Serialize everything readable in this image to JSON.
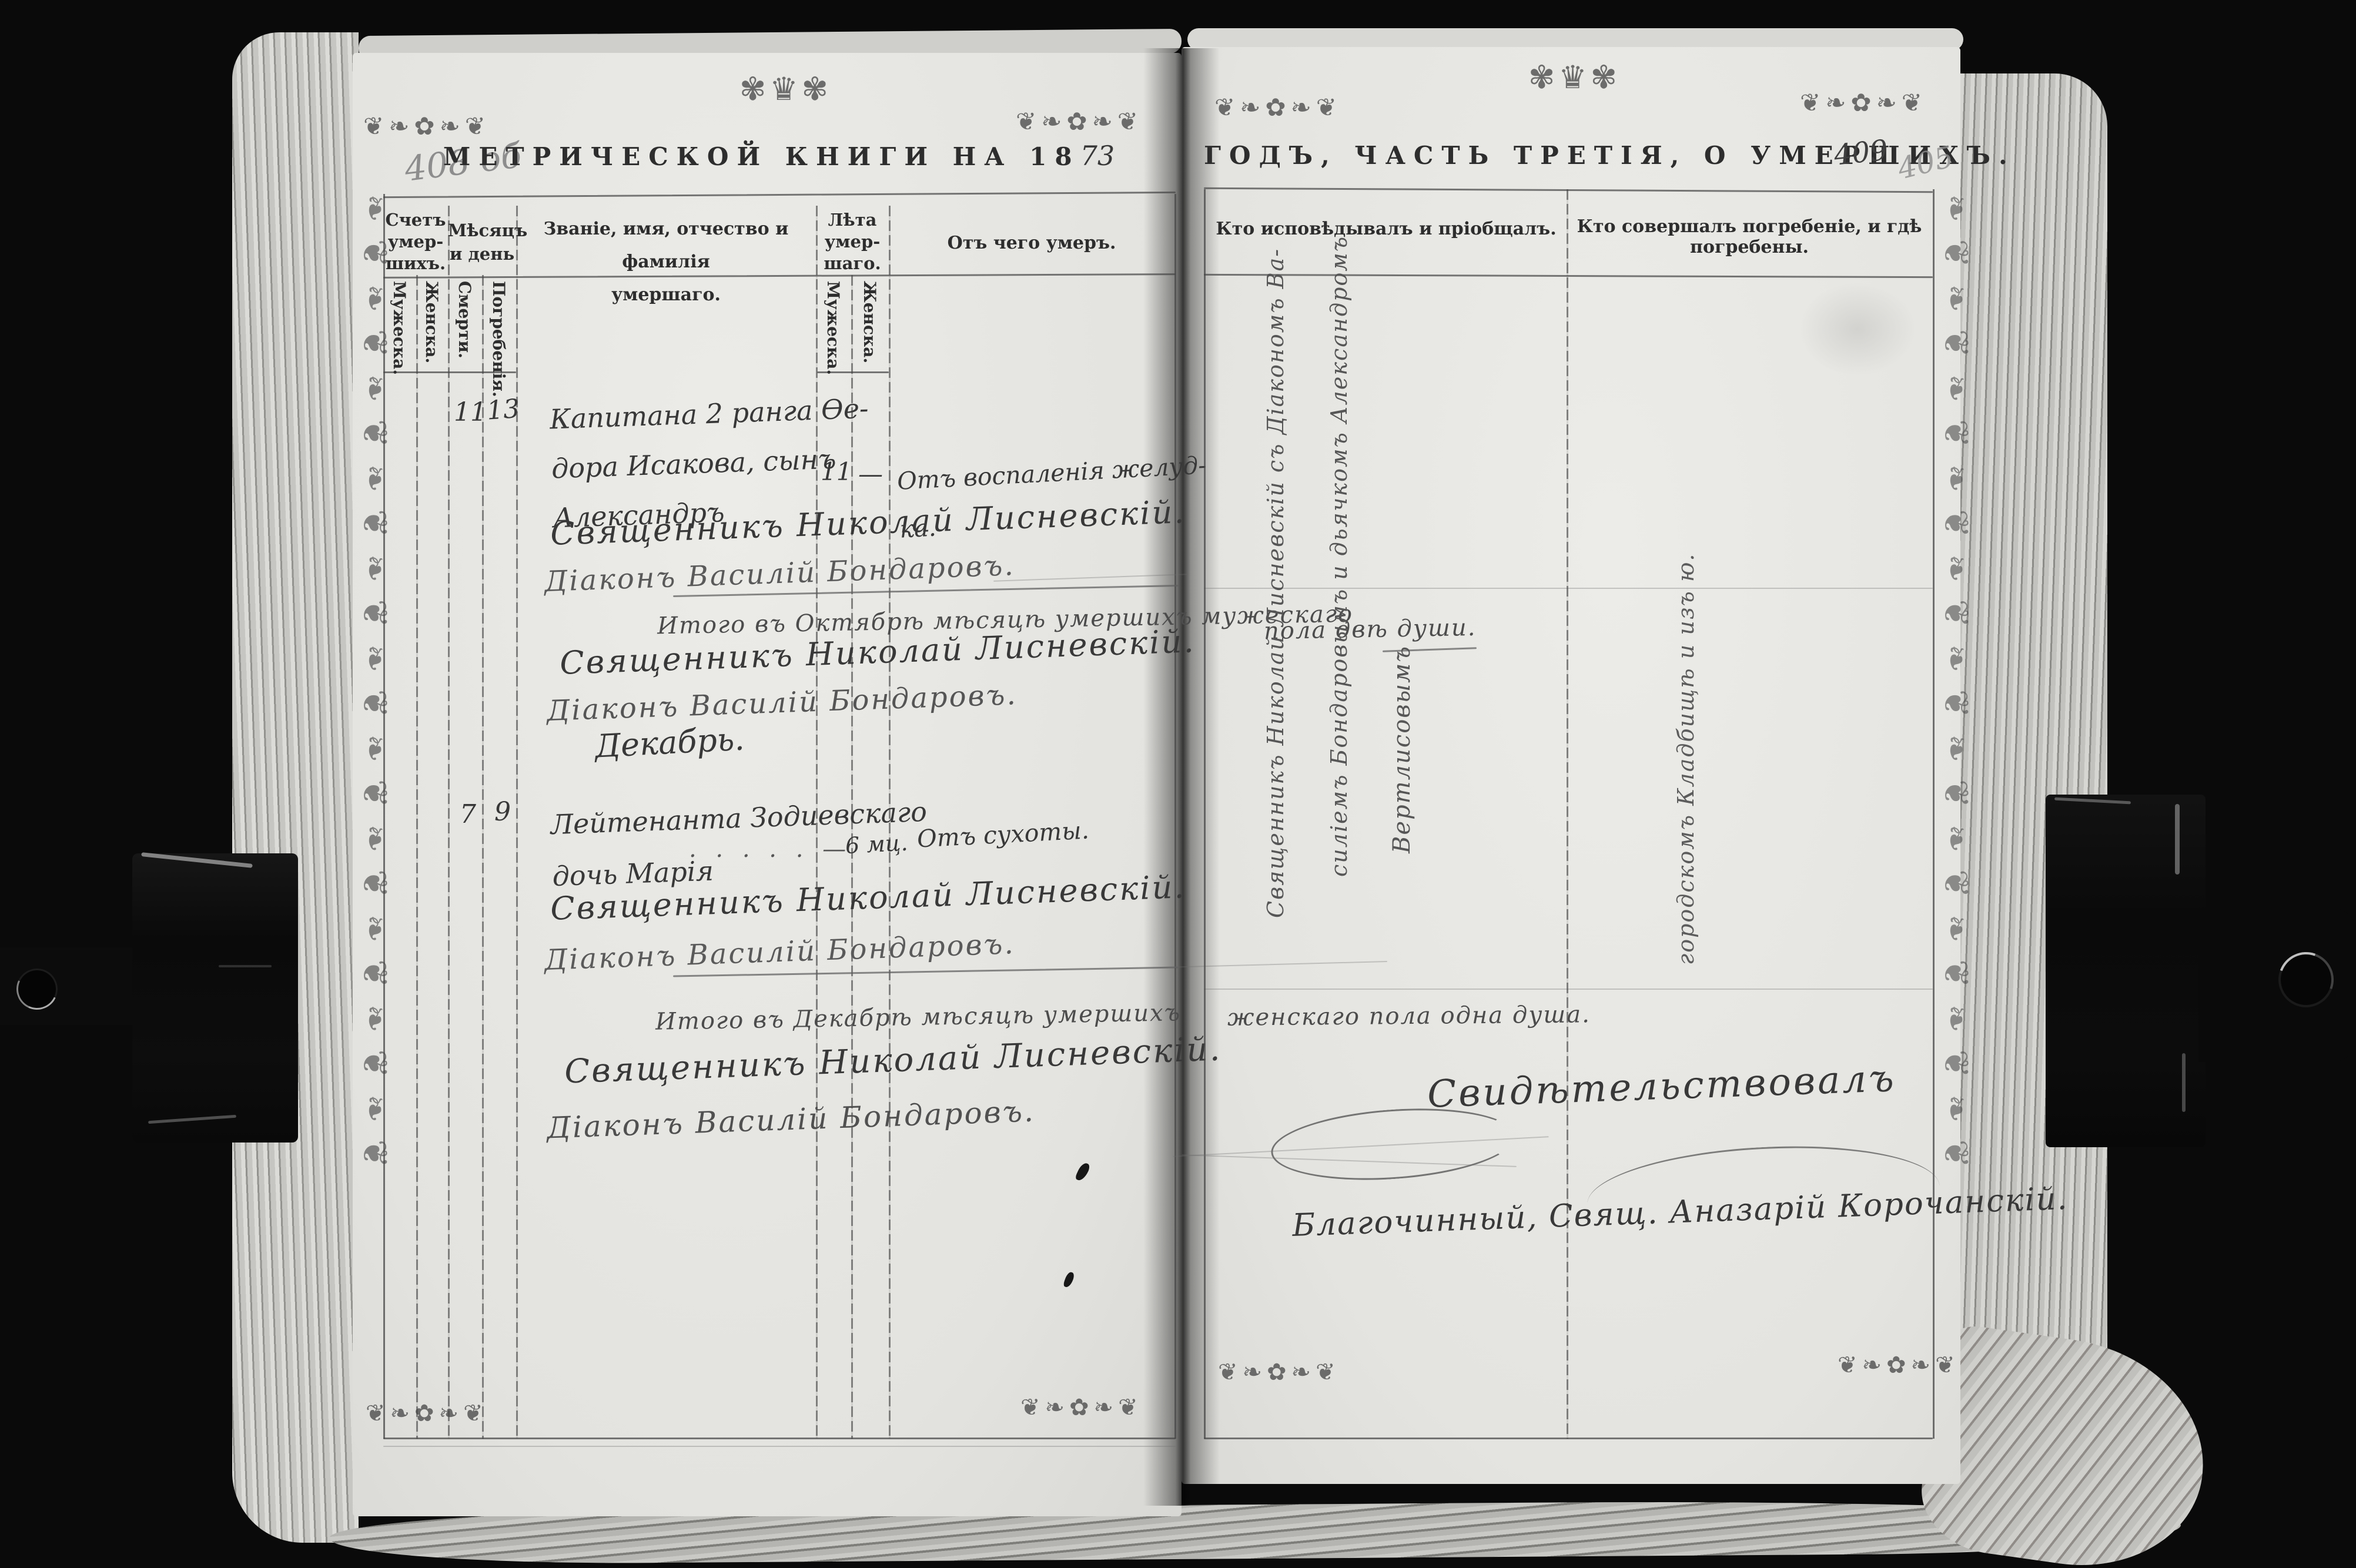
{
  "decor": {
    "corner": "❦❧✿❧❦",
    "crown": "✾♛✾",
    "strip": "❧❦❧❦❧❦❧❦❧❦❧❦❧❦❧❦❧❦❧❦❧❦"
  },
  "left_page": {
    "page_number_pencil": "408 об",
    "title_printed": "МЕТРИЧЕСКОЙ КНИГИ НА 18",
    "title_year_handwritten": "73",
    "columns": {
      "count_title": "Счетъ\nумер-\nшихъ.",
      "count_male": "Мужеска.",
      "count_female": "Женска.",
      "month_title": "Мѣсяцъ\nи день",
      "month_death": "Смерти.",
      "month_burial": "Погребенія.",
      "name_title": "Званіе, имя, отчество и фамилія\nумершаго.",
      "age_title": "Лѣта\nумер-\nшаго.",
      "age_male": "Мужеска.",
      "age_female": "Женска.",
      "cause_title": "Отъ чего умеръ."
    },
    "entries": [
      {
        "death_day": "11",
        "burial_day": "13",
        "name_lines": "Капитана 2 ранга Ѳе-\nдора Исакова, сынъ\nАлександръ",
        "age_male": "11",
        "age_female": "—",
        "cause_lines": "Отъ воспаленія желуд-\nка.",
        "priest": "Священникъ Николай Лисневскій.",
        "deacon": "Діаконъ Василій Бондаровъ."
      },
      {
        "death_day": "7",
        "burial_day": "9",
        "name_lines": "Лейтенанта Зодиевскаго\nдочь Марія",
        "leader": ". . . . . —",
        "age_female": "6 мц.",
        "cause_lines": "Отъ сухоты.",
        "priest": "Священникъ Николай Лисневскій.",
        "deacon": "Діаконъ Василій Бондаровъ."
      }
    ],
    "summary_october": "Итого въ Октябрѣ мѣсяцѣ умершихъ мужескаго",
    "summary_october_signatures": {
      "priest": "Священникъ Николай Лисневскій.",
      "deacon": "Діаконъ Василій Бондаровъ."
    },
    "month_label_december": "Декабрь.",
    "summary_december": "Итого въ Декабрѣ мѣсяцѣ умершихъ",
    "summary_december_signatures": {
      "priest": "Священникъ Николай Лисневскій.",
      "deacon": "Діаконъ Василій Бондаровъ."
    }
  },
  "right_page": {
    "page_number_ink": "409",
    "page_number_pencil": "405",
    "title_printed": "ГОДЪ, ЧАСТЬ ТРЕТІЯ, О УМЕРШИХЪ.",
    "columns": {
      "confession_title": "Кто исповѣдывалъ и пріобщалъ.",
      "burial_title": "Кто совершалъ погребеніе, и гдѣ погребены."
    },
    "confession_note_line1": "Священникъ Николай Лисневскій съ Діакономъ Ва-",
    "confession_note_line2": "силіемъ Бондаровымъ и дьячкомъ Александромъ",
    "confession_note_line3": "Вертлисовымъ",
    "burial_note": "городскомъ Кладбищѣ и изъ ю.",
    "summary_october_continuation": "пола двѣ души.",
    "summary_december_continuation": "женскаго пола одна душа.",
    "certification_line1": "Свидѣтельствовалъ",
    "certification_line2": "Благочинный, Свящ. Аназарій Корочанскій."
  }
}
